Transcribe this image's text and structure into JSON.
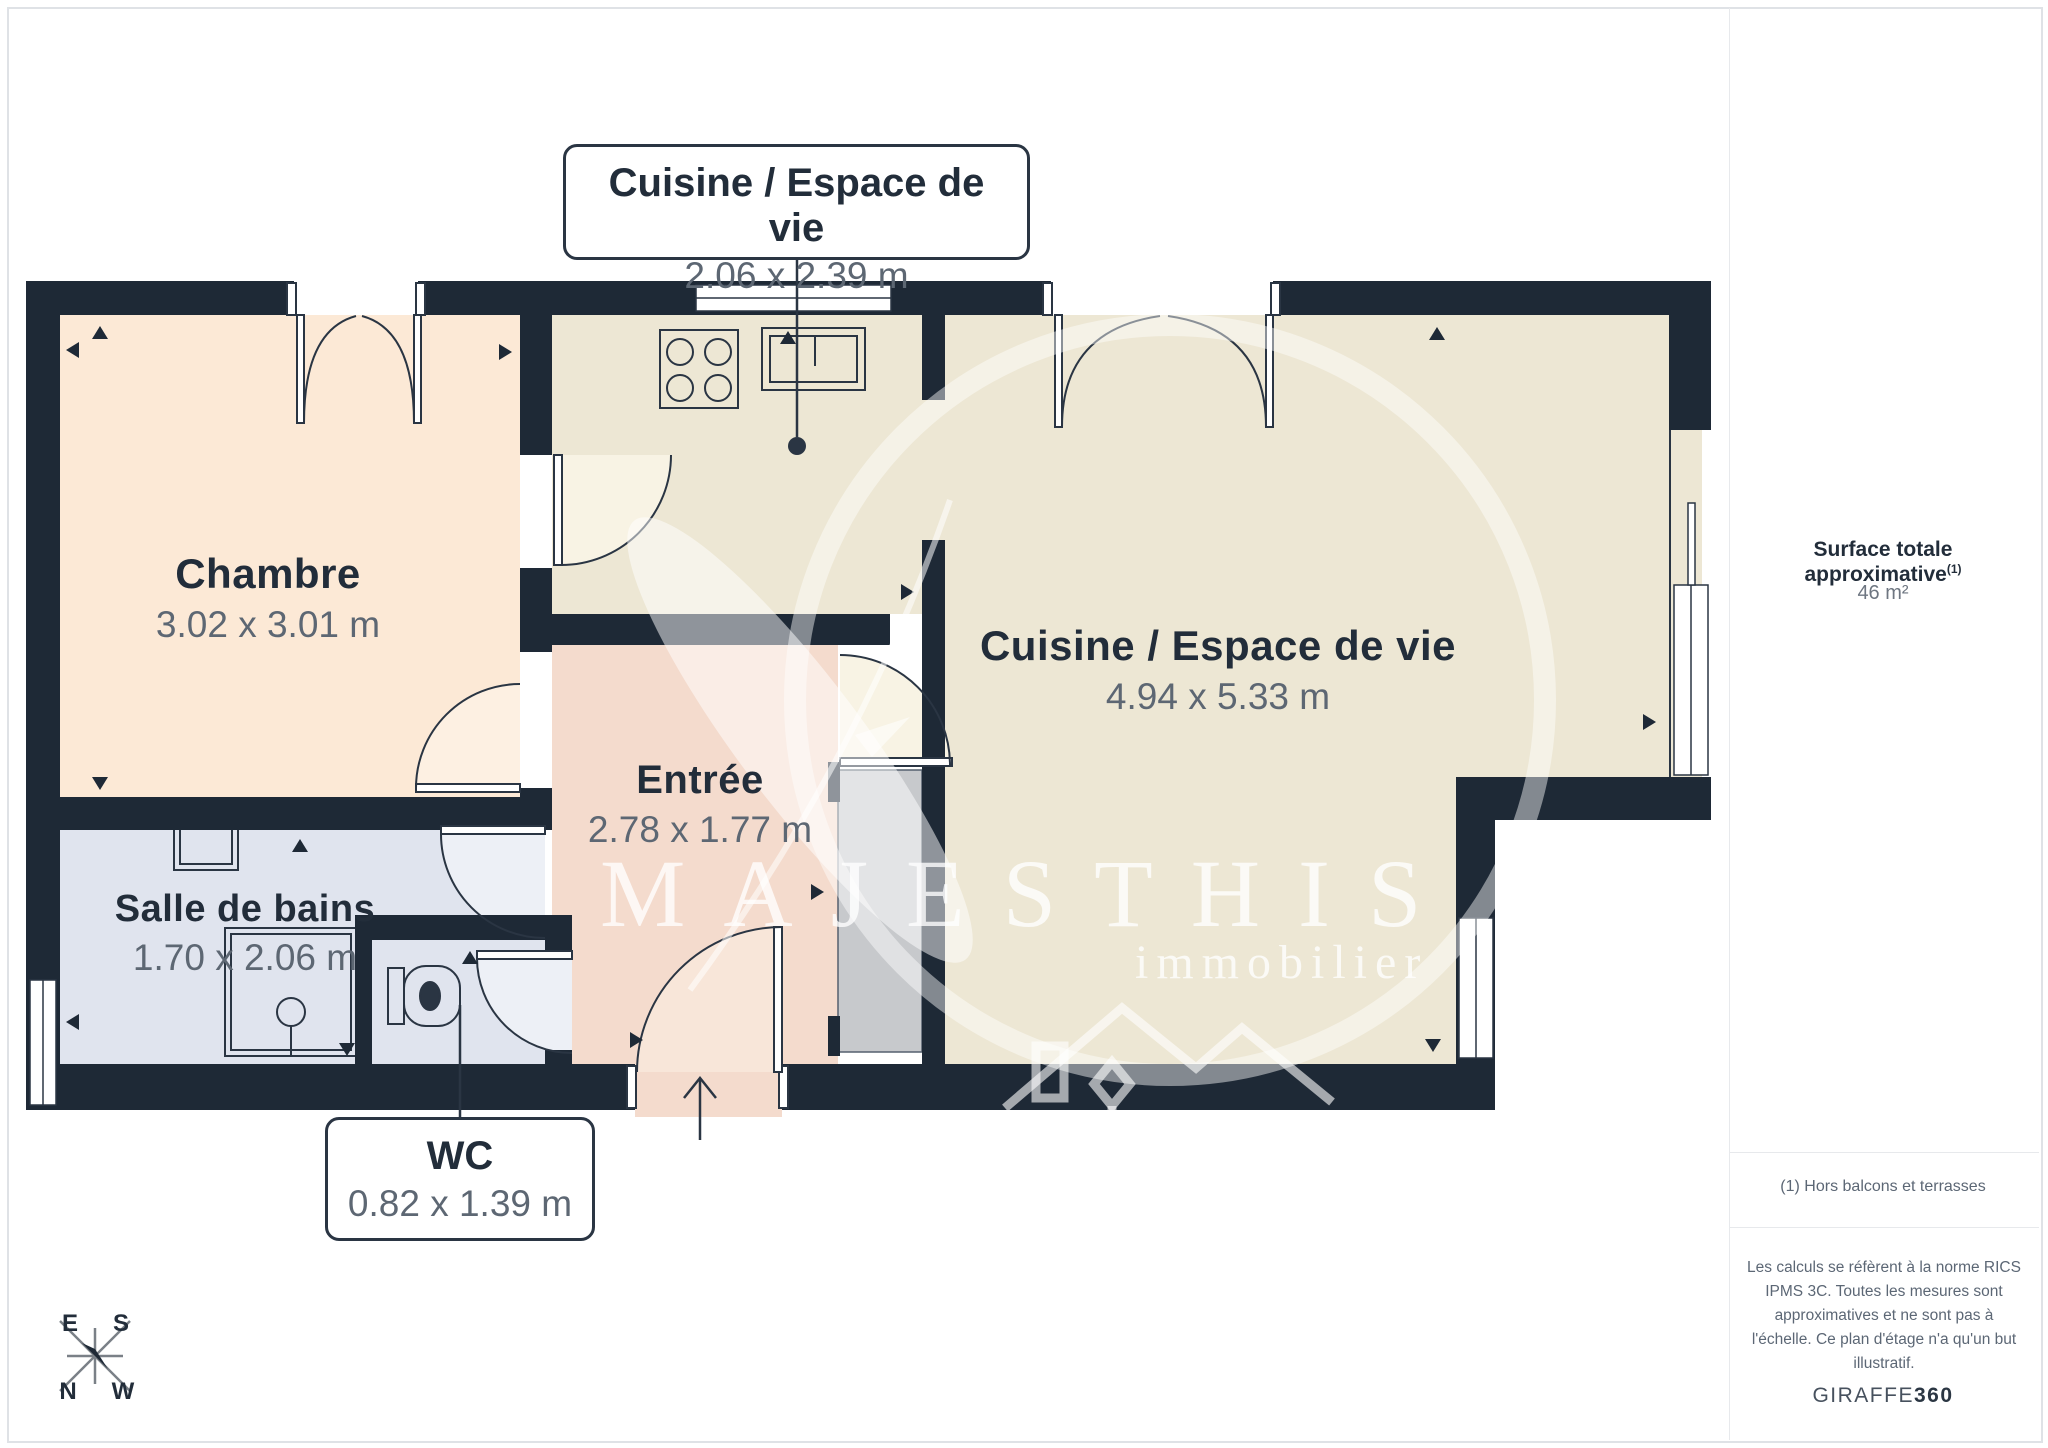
{
  "plan": {
    "callouts": [
      {
        "title": "Cuisine / Espace de vie",
        "dims": "2.06 x 2.39 m"
      },
      {
        "title": "WC",
        "dims": "0.82 x 1.39 m"
      }
    ],
    "rooms": [
      {
        "name": "Chambre",
        "dims": "3.02 x 3.01 m"
      },
      {
        "name": "Cuisine / Espace de vie",
        "dims": "4.94 x 5.33 m"
      },
      {
        "name": "Entrée",
        "dims": "2.78 x 1.77 m"
      },
      {
        "name": "Salle de bains",
        "dims": "1.70 x 2.06 m"
      }
    ],
    "watermark": {
      "line1": "MAJESTHIS",
      "line2": "immobilier"
    },
    "compass": {
      "e": "E",
      "s": "S",
      "n": "N",
      "w": "W"
    }
  },
  "sidebar": {
    "surface_label": "Surface totale approximative",
    "surface_sup": "(1)",
    "surface_value": "46 m²",
    "footnote": "(1) Hors balcons et terrasses",
    "disclaimer": "Les calculs se réfèrent à la norme RICS IPMS 3C. Toutes les mesures sont approximatives et ne sont pas à l'échelle. Ce plan d'étage n'a qu'un but illustratif.",
    "brand": "GIRAFFE",
    "brand_bold": "360"
  },
  "colors": {
    "wall": "#1e2936",
    "chambre_fill": "#fce9d6",
    "living_fill": "#ede7d4",
    "entree_fill": "#f4dbcd",
    "bath_fill": "#e0e4ee",
    "shaft_fill": "#c7c9cc",
    "dim_text": "#5d6773",
    "name_text": "#222d3a"
  }
}
